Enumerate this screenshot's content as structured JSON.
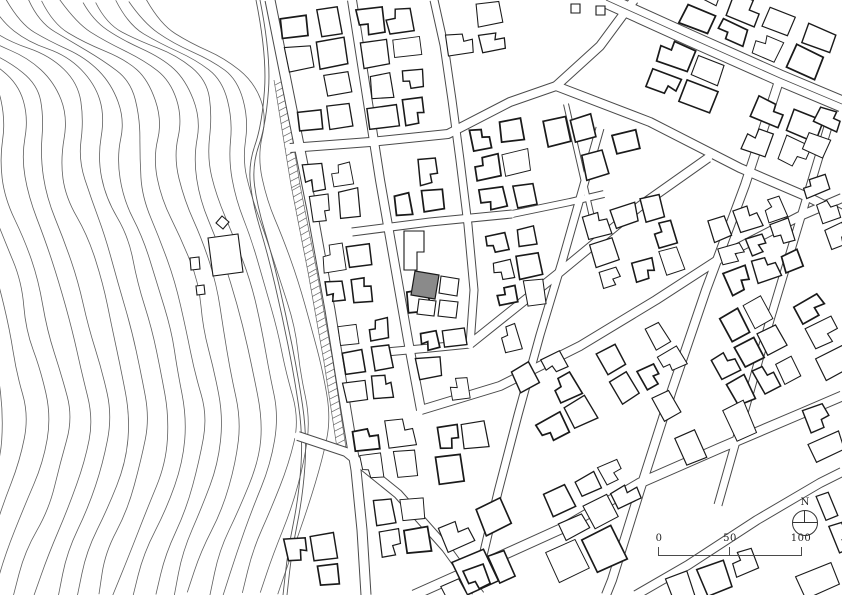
{
  "map": {
    "background": "#ffffff",
    "contour_color": "#5f5f5f",
    "stream_color": "#555555",
    "road_casing_color": "#4a4a4a",
    "road_fill_color": "#ffffff",
    "building_stroke_color": "#1a1a1a",
    "building_fill_color": "#ffffff",
    "site_fill_color": "#8a8a8a",
    "contours": {
      "count": 19,
      "spacing": 16.5,
      "wiggle": 7,
      "base": [
        [
          148,
          0
        ],
        [
          160,
          22
        ],
        [
          190,
          42
        ],
        [
          228,
          58
        ],
        [
          256,
          82
        ],
        [
          266,
          118
        ],
        [
          260,
          158
        ],
        [
          268,
          198
        ],
        [
          286,
          238
        ],
        [
          300,
          282
        ],
        [
          310,
          328
        ],
        [
          320,
          372
        ],
        [
          330,
          418
        ],
        [
          324,
          462
        ],
        [
          306,
          508
        ],
        [
          288,
          552
        ],
        [
          276,
          595
        ]
      ]
    },
    "stream": {
      "gap": 4,
      "pts": [
        [
          256,
          0
        ],
        [
          267,
          55
        ],
        [
          262,
          125
        ],
        [
          248,
          165
        ],
        [
          253,
          205
        ],
        [
          268,
          255
        ],
        [
          282,
          315
        ],
        [
          294,
          375
        ],
        [
          303,
          435
        ],
        [
          299,
          495
        ],
        [
          288,
          550
        ],
        [
          283,
          595
        ]
      ]
    },
    "hatch_band": {
      "pts": [
        [
          288,
          80
        ],
        [
          305,
          185
        ],
        [
          322,
          272
        ],
        [
          338,
          362
        ],
        [
          351,
          448
        ]
      ],
      "offset": 5,
      "depth": 9,
      "step": 6.5
    },
    "streets": [
      {
        "name": "avenue",
        "w": 15,
        "center": true,
        "pts": [
          [
            606,
            0
          ],
          [
            690,
            38
          ],
          [
            780,
            78
          ],
          [
            842,
            104
          ]
        ]
      },
      {
        "name": "upper-diagonal",
        "w": 8,
        "pts": [
          [
            556,
            86
          ],
          [
            650,
            122
          ],
          [
            740,
            168
          ],
          [
            810,
            198
          ],
          [
            842,
            214
          ]
        ]
      },
      {
        "name": "field-bend-road",
        "w": 8,
        "pts": [
          [
            290,
            148
          ],
          [
            370,
            142
          ],
          [
            448,
            134
          ],
          [
            510,
            102
          ],
          [
            556,
            86
          ]
        ]
      },
      {
        "name": "field-branch",
        "w": 8,
        "pts": [
          [
            556,
            86
          ],
          [
            600,
            46
          ],
          [
            634,
            0
          ]
        ]
      },
      {
        "name": "main-ns-street",
        "w": 9,
        "pts": [
          [
            270,
            0
          ],
          [
            290,
            100
          ],
          [
            312,
            210
          ],
          [
            330,
            310
          ],
          [
            346,
            410
          ],
          [
            356,
            470
          ],
          [
            362,
            530
          ],
          [
            366,
            595
          ]
        ]
      },
      {
        "name": "ns-street-2",
        "w": 8,
        "pts": [
          [
            352,
            0
          ],
          [
            366,
            90
          ],
          [
            380,
            180
          ],
          [
            394,
            260
          ],
          [
            408,
            340
          ],
          [
            421,
            410
          ]
        ]
      },
      {
        "name": "ns-street-3",
        "w": 7,
        "pts": [
          [
            434,
            0
          ],
          [
            444,
            45
          ],
          [
            452,
            100
          ],
          [
            460,
            160
          ],
          [
            468,
            225
          ],
          [
            474,
            290
          ],
          [
            470,
            345
          ]
        ]
      },
      {
        "name": "narrow-lane",
        "w": 4,
        "pts": [
          [
            566,
            104
          ],
          [
            580,
            165
          ],
          [
            594,
            226
          ]
        ]
      },
      {
        "name": "ew-street-2",
        "w": 7,
        "pts": [
          [
            352,
            232
          ],
          [
            430,
            222
          ],
          [
            512,
            214
          ]
        ]
      },
      {
        "name": "ew-connector",
        "w": 6,
        "pts": [
          [
            512,
            214
          ],
          [
            570,
            202
          ],
          [
            604,
            194
          ]
        ]
      },
      {
        "name": "ew-street-3",
        "w": 7,
        "pts": [
          [
            386,
            352
          ],
          [
            430,
            348
          ],
          [
            470,
            344
          ]
        ]
      },
      {
        "name": "diag-street-1",
        "w": 8,
        "pts": [
          [
            470,
            344
          ],
          [
            560,
            272
          ],
          [
            640,
            206
          ],
          [
            708,
            158
          ]
        ]
      },
      {
        "name": "diag-street-2",
        "w": 8,
        "pts": [
          [
            421,
            410
          ],
          [
            500,
            386
          ],
          [
            580,
            346
          ],
          [
            656,
            300
          ],
          [
            730,
            252
          ],
          [
            800,
            216
          ],
          [
            842,
            198
          ]
        ]
      },
      {
        "name": "diag-street-3",
        "w": 9,
        "pts": [
          [
            414,
            595
          ],
          [
            470,
            570
          ],
          [
            565,
            527
          ],
          [
            640,
            483
          ],
          [
            720,
            448
          ],
          [
            800,
            414
          ],
          [
            842,
            396
          ]
        ]
      },
      {
        "name": "cross-street-0",
        "w": 7,
        "pts": [
          [
            600,
            128
          ],
          [
            583,
            188
          ],
          [
            562,
            262
          ],
          [
            540,
            335
          ],
          [
            518,
            415
          ],
          [
            498,
            492
          ],
          [
            482,
            560
          ],
          [
            476,
            595
          ]
        ]
      },
      {
        "name": "cross-street-1",
        "w": 8,
        "pts": [
          [
            780,
            78
          ],
          [
            745,
            185
          ],
          [
            706,
            290
          ],
          [
            672,
            390
          ],
          [
            640,
            490
          ],
          [
            612,
            580
          ],
          [
            606,
            595
          ]
        ]
      },
      {
        "name": "cross-street-2",
        "w": 7,
        "pts": [
          [
            830,
            120
          ],
          [
            800,
            220
          ],
          [
            770,
            320
          ],
          [
            742,
            420
          ],
          [
            718,
            505
          ]
        ]
      },
      {
        "name": "bridge-diagonal",
        "w": 8,
        "pts": [
          [
            298,
            436
          ],
          [
            346,
            452
          ],
          [
            398,
            494
          ],
          [
            446,
            548
          ],
          [
            480,
            595
          ]
        ]
      },
      {
        "name": "lower-corner-road",
        "w": 8,
        "pts": [
          [
            636,
            595
          ],
          [
            688,
            565
          ],
          [
            757,
            520
          ],
          [
            820,
            483
          ],
          [
            842,
            472
          ]
        ]
      }
    ],
    "blocks": [
      [
        286,
        8,
        64,
        124,
        -8,
        2,
        4,
        0.95,
        1
      ],
      [
        360,
        4,
        64,
        126,
        -8,
        2,
        4,
        0.92,
        2
      ],
      [
        444,
        4,
        62,
        52,
        -8,
        2,
        2,
        0.75,
        3
      ],
      [
        304,
        158,
        56,
        64,
        -8,
        2,
        2,
        0.9,
        4
      ],
      [
        320,
        240,
        56,
        66,
        -8,
        2,
        2,
        0.9,
        5
      ],
      [
        338,
        316,
        56,
        86,
        -8,
        2,
        3,
        0.9,
        6
      ],
      [
        354,
        418,
        64,
        64,
        -8,
        2,
        2,
        0.88,
        7
      ],
      [
        372,
        496,
        58,
        60,
        -8,
        2,
        2,
        0.85,
        8
      ],
      [
        390,
        156,
        54,
        62,
        -8,
        2,
        2,
        0.9,
        9
      ],
      [
        402,
        230,
        54,
        84,
        -8,
        2,
        3,
        0.35,
        10
      ],
      [
        416,
        324,
        56,
        80,
        -8,
        2,
        3,
        0.9,
        11
      ],
      [
        434,
        420,
        56,
        64,
        -8,
        2,
        2,
        0.85,
        12
      ],
      [
        474,
        118,
        58,
        94,
        -10,
        2,
        3,
        0.9,
        13
      ],
      [
        488,
        226,
        56,
        84,
        -10,
        2,
        3,
        0.9,
        14
      ],
      [
        502,
        318,
        52,
        66,
        -14,
        2,
        2,
        0.85,
        15
      ],
      [
        548,
        112,
        54,
        72,
        -14,
        2,
        2,
        0.9,
        16
      ],
      [
        606,
        124,
        38,
        60,
        -14,
        1,
        2,
        0.9,
        17
      ],
      [
        676,
        0,
        160,
        56,
        22,
        4,
        2,
        0.8,
        18
      ],
      [
        648,
        44,
        76,
        64,
        22,
        2,
        2,
        0.85,
        19
      ],
      [
        740,
        98,
        82,
        66,
        22,
        2,
        2,
        0.85,
        20
      ],
      [
        588,
        202,
        92,
        84,
        -16,
        3,
        3,
        0.9,
        21
      ],
      [
        714,
        202,
        86,
        82,
        -20,
        3,
        3,
        0.9,
        22
      ],
      [
        810,
        174,
        32,
        78,
        -20,
        1,
        3,
        0.9,
        23
      ],
      [
        520,
        352,
        64,
        86,
        -28,
        2,
        3,
        0.85,
        24
      ],
      [
        608,
        328,
        82,
        96,
        -28,
        3,
        3,
        0.9,
        25
      ],
      [
        710,
        306,
        80,
        92,
        -28,
        3,
        3,
        0.9,
        26
      ],
      [
        800,
        292,
        42,
        86,
        -28,
        1,
        3,
        0.88,
        27
      ],
      [
        444,
        502,
        82,
        82,
        -24,
        2,
        2,
        0.85,
        28
      ],
      [
        548,
        470,
        90,
        58,
        -26,
        3,
        2,
        0.88,
        29
      ],
      [
        674,
        410,
        84,
        50,
        -24,
        3,
        1,
        0.85,
        30
      ],
      [
        548,
        532,
        76,
        46,
        -26,
        2,
        1,
        0.8,
        31
      ],
      [
        804,
        404,
        38,
        56,
        -22,
        1,
        2,
        0.85,
        32
      ],
      [
        664,
        560,
        100,
        34,
        -22,
        3,
        1,
        0.9,
        33
      ],
      [
        436,
        562,
        84,
        32,
        -24,
        3,
        1,
        0.8,
        34
      ],
      [
        282,
        534,
        58,
        58,
        -8,
        2,
        2,
        0.85,
        35
      ],
      [
        806,
        100,
        34,
        58,
        22,
        1,
        2,
        0.9,
        36
      ],
      [
        796,
        564,
        46,
        30,
        -22,
        1,
        1,
        0.9,
        37
      ],
      [
        824,
        488,
        18,
        66,
        -22,
        1,
        2,
        0.9,
        38
      ]
    ],
    "site_building": {
      "fill": "#8a8a8a",
      "pts": [
        [
          415,
          271
        ],
        [
          439,
          275
        ],
        [
          435,
          299
        ],
        [
          411,
          295
        ]
      ]
    },
    "structures": [
      {
        "name": "neighbor-tall-L",
        "pts": [
          [
            404,
            231
          ],
          [
            424,
            231
          ],
          [
            424,
            252
          ],
          [
            417,
            252
          ],
          [
            417,
            270
          ],
          [
            404,
            270
          ]
        ]
      },
      {
        "name": "neighbor-east",
        "pts": [
          [
            441,
            276
          ],
          [
            459,
            279
          ],
          [
            457,
            296
          ],
          [
            439,
            293
          ]
        ]
      },
      {
        "name": "neighbor-south-1",
        "pts": [
          [
            419,
            299
          ],
          [
            436,
            301
          ],
          [
            434,
            316
          ],
          [
            417,
            314
          ]
        ]
      },
      {
        "name": "neighbor-south-2",
        "pts": [
          [
            440,
            300
          ],
          [
            458,
            302
          ],
          [
            456,
            318
          ],
          [
            438,
            316
          ]
        ]
      },
      {
        "name": "hill-building-large",
        "pts": [
          [
            208,
            238
          ],
          [
            238,
            234
          ],
          [
            243,
            272
          ],
          [
            213,
            276
          ]
        ]
      },
      {
        "name": "hill-shed-1",
        "pts": [
          [
            190,
            258
          ],
          [
            199,
            257
          ],
          [
            200,
            269
          ],
          [
            191,
            270
          ]
        ]
      },
      {
        "name": "hill-shed-2",
        "pts": [
          [
            196,
            286
          ],
          [
            204,
            285
          ],
          [
            205,
            294
          ],
          [
            197,
            295
          ]
        ]
      },
      {
        "name": "hill-shed-3",
        "pts": [
          [
            222,
            216
          ],
          [
            229,
            222
          ],
          [
            223,
            229
          ],
          [
            216,
            223
          ]
        ]
      },
      {
        "name": "field-shed-1",
        "pts": [
          [
            571,
            4
          ],
          [
            580,
            4
          ],
          [
            580,
            13
          ],
          [
            571,
            13
          ]
        ]
      },
      {
        "name": "field-shed-2",
        "pts": [
          [
            596,
            6
          ],
          [
            605,
            6
          ],
          [
            605,
            15
          ],
          [
            596,
            15
          ]
        ]
      }
    ]
  },
  "legend": {
    "north_label": "N",
    "scale_labels": [
      "0",
      "50",
      "100"
    ]
  }
}
